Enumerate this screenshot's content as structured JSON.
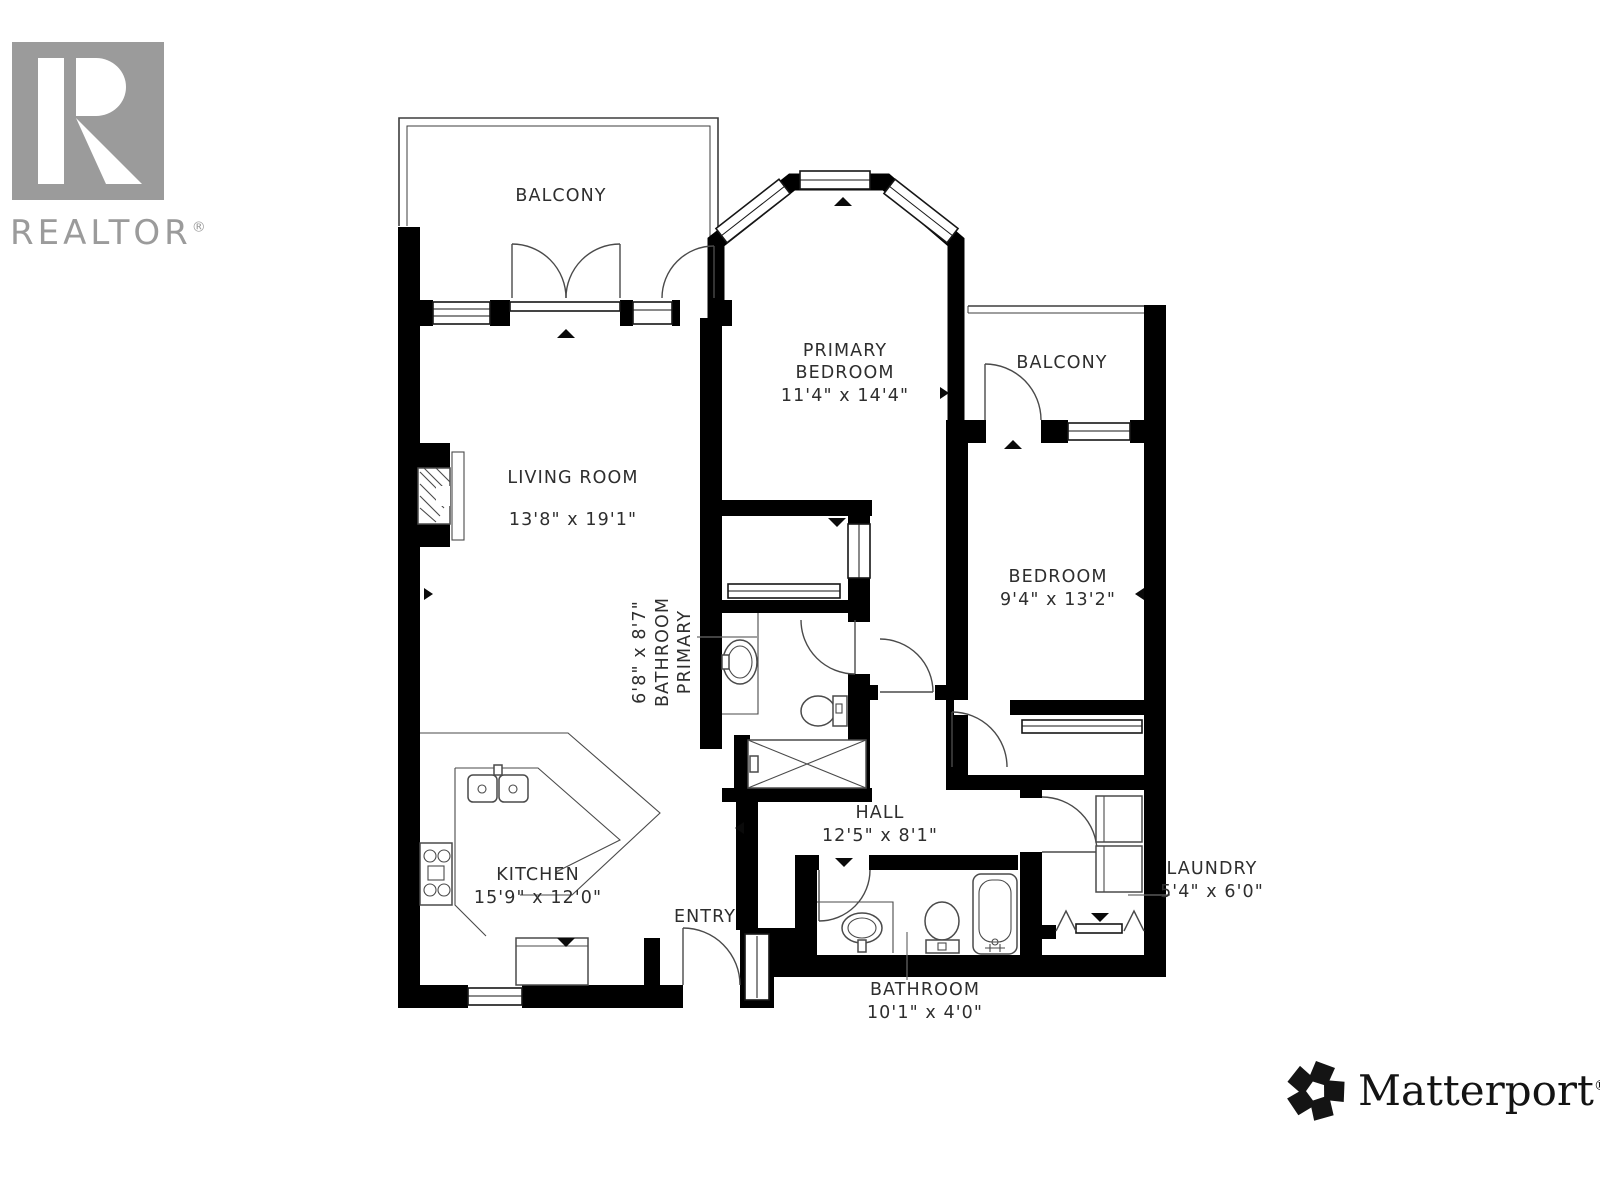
{
  "branding": {
    "realtor": {
      "wordmark": "REALTOR",
      "registered": "®"
    },
    "matterport": {
      "wordmark": "Matterport",
      "registered": "®"
    }
  },
  "palette": {
    "wall": "#000000",
    "thin_line": "#3d3d3d",
    "label_text": "#2e2e2e",
    "logo_gray": "#9b9b9b",
    "background": "#ffffff"
  },
  "rooms": [
    {
      "id": "balcony-top",
      "cx": 561,
      "cy": 201,
      "rot": 0,
      "lines": [
        {
          "t": "BALCONY",
          "dy": 0
        }
      ]
    },
    {
      "id": "primary-bedroom",
      "cx": 845,
      "cy": 356,
      "rot": 0,
      "lines": [
        {
          "t": "PRIMARY",
          "dy": 0
        },
        {
          "t": "BEDROOM",
          "dy": 22
        },
        {
          "t": "11'4\" x 14'4\"",
          "dy": 45
        }
      ]
    },
    {
      "id": "balcony-right",
      "cx": 1062,
      "cy": 368,
      "rot": 0,
      "lines": [
        {
          "t": "BALCONY",
          "dy": 0
        }
      ]
    },
    {
      "id": "living-room",
      "cx": 573,
      "cy": 483,
      "rot": 0,
      "lines": [
        {
          "t": "LIVING ROOM",
          "dy": 0
        },
        {
          "t": "13'8\" x 19'1\"",
          "dy": 42
        }
      ]
    },
    {
      "id": "bedroom",
      "cx": 1058,
      "cy": 582,
      "rot": 0,
      "lines": [
        {
          "t": "BEDROOM",
          "dy": 0
        },
        {
          "t": "9'4\" x 13'2\"",
          "dy": 23
        }
      ]
    },
    {
      "id": "primary-bathroom",
      "cx": 690,
      "cy": 652,
      "rot": -90,
      "lines": [
        {
          "t": "PRIMARY",
          "dy": 0
        },
        {
          "t": "BATHROOM",
          "dy": -22
        },
        {
          "t": "6'8\" x 8'7\"",
          "dy": -45
        }
      ]
    },
    {
      "id": "hall",
      "cx": 880,
      "cy": 818,
      "rot": 0,
      "lines": [
        {
          "t": "HALL",
          "dy": 0
        },
        {
          "t": "12'5\" x 8'1\"",
          "dy": 23
        }
      ]
    },
    {
      "id": "kitchen",
      "cx": 538,
      "cy": 880,
      "rot": 0,
      "lines": [
        {
          "t": "KITCHEN",
          "dy": 0
        },
        {
          "t": "15'9\" x 12'0\"",
          "dy": 23
        }
      ]
    },
    {
      "id": "entry",
      "cx": 705,
      "cy": 922,
      "rot": 0,
      "lines": [
        {
          "t": "ENTRY",
          "dy": 0
        }
      ]
    },
    {
      "id": "laundry",
      "cx": 1212,
      "cy": 874,
      "rot": 0,
      "lines": [
        {
          "t": "LAUNDRY",
          "dy": 0
        },
        {
          "t": "5'4\" x 6'0\"",
          "dy": 23
        }
      ]
    },
    {
      "id": "bathroom",
      "cx": 925,
      "cy": 995,
      "rot": 0,
      "lines": [
        {
          "t": "BATHROOM",
          "dy": 0
        },
        {
          "t": "10'1\" x 4'0\"",
          "dy": 23
        }
      ]
    }
  ]
}
